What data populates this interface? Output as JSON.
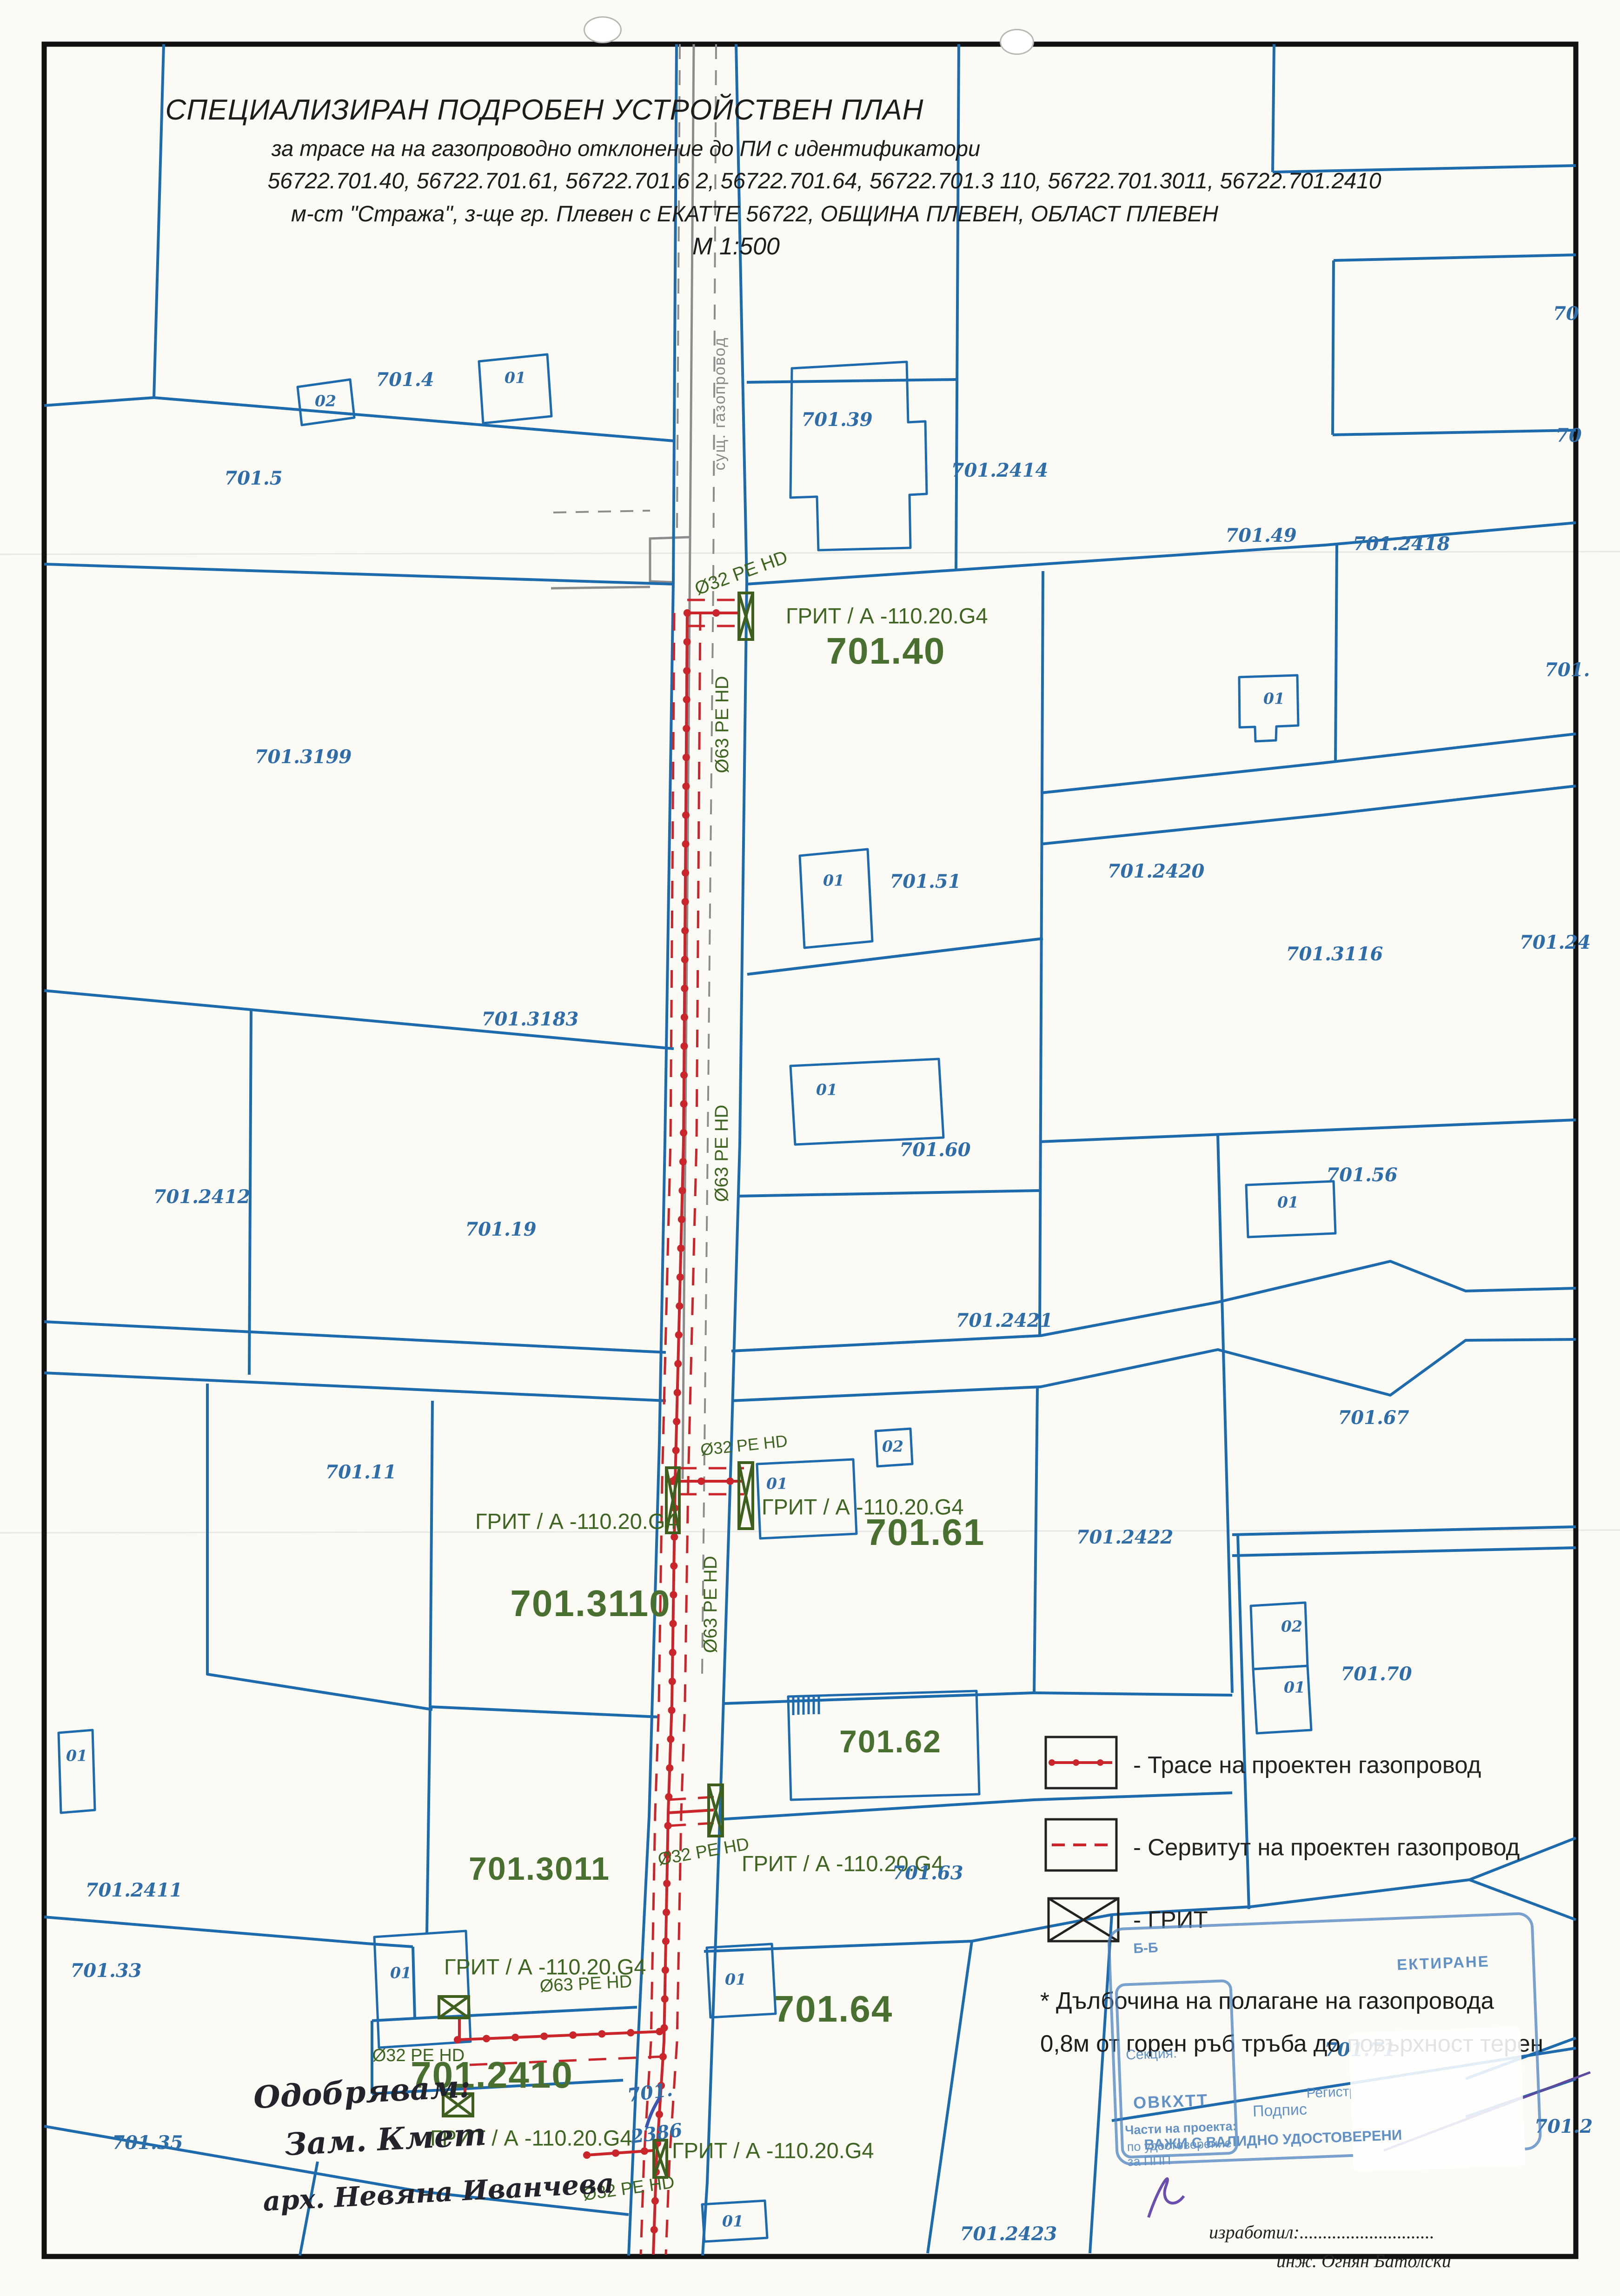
{
  "title": {
    "line1": "СПЕЦИАЛИЗИРАН ПОДРОБЕН УСТРОЙСТВЕН ПЛАН",
    "line2": "за трасе на на газопроводно отклонение до ПИ с идентификатори",
    "line3": "56722.701.40, 56722.701.61, 56722.701.6 2, 56722.701.64, 56722.701.3 110, 56722.701.3011, 56722.701.2410",
    "line4": "м-ст \"Стража\", з-ще гр. Плевен с ЕКАТТЕ 56722, ОБЩИНА ПЛЕВЕН, ОБЛАСТ ПЛЕВЕН",
    "line5": "М 1:500"
  },
  "map": {
    "road_label": "сущ. газопровод",
    "pipe32": "Ø32 PE HD",
    "pipe63": "Ø63 PE HD",
    "grit_label": "ГРИТ / А -110.20.G4",
    "b01": "01",
    "b02": "02",
    "green": {
      "p40": "701.40",
      "p61": "701.61",
      "p3110": "701.3110",
      "p62": "701.62",
      "p3011": "701.3011",
      "p64": "701.64",
      "p2410": "701.2410"
    },
    "parcels": {
      "p4": "701.4",
      "p5": "701.5",
      "p39": "701.39",
      "p2414": "701.2414",
      "p49": "701.49",
      "p2418": "701.2418",
      "p3199": "701.3199",
      "p51": "701.51",
      "p2420": "701.2420",
      "p3116": "701.3116",
      "p3183": "701.3183",
      "p60": "701.60",
      "p2412": "701.2412",
      "p19": "701.19",
      "p56": "701.56",
      "p2421": "701.2421",
      "p67": "701.67",
      "p11": "701.11",
      "p2422": "701.2422",
      "p70": "701.70",
      "p2411": "701.2411",
      "p63": "701.63",
      "p33": "701.33",
      "p2386a": "701.",
      "p2386b": "2386",
      "p35": "701.35",
      "p2423": "701.2423",
      "p71": "701.71",
      "edge_a": "70",
      "edge_b": "70",
      "edge_c": "701.",
      "edge_d": "701.24",
      "edge_e": "701.2"
    }
  },
  "legend": {
    "route": "- Трасе на проектен газопровод",
    "servitude": "- Сервитут на проектен газопровод",
    "grit": "- ГРИТ",
    "note1": "* Дълбочина на полагане на газопровода",
    "note2": "0,8м от горен ръб тръба до повърхност терен"
  },
  "stamp": {
    "code": "Б-Б",
    "top": "ЕКТИРАНЕ",
    "ability": "СПОСОБНОСТ",
    "reg_label": "Регистрационен №",
    "reg_number": "07336",
    "section_label": "Секция:",
    "section_value": "ОВКХТТ",
    "parts_label": "Части на проекта:",
    "parts_value1": "по удостоверение",
    "parts_value2": "за ППП",
    "sign_label": "Подпис",
    "validity": "ВАЖИ С ВАЛИДНО УДОСТОВЕРЕНИ"
  },
  "approval": {
    "line1": "Одобрявам:",
    "line2": "Зам. Кмет",
    "line3": "арх. Невяна Иванчева"
  },
  "author": {
    "label": "изработил:.............................",
    "name": "инж. Огнян Батолски"
  }
}
